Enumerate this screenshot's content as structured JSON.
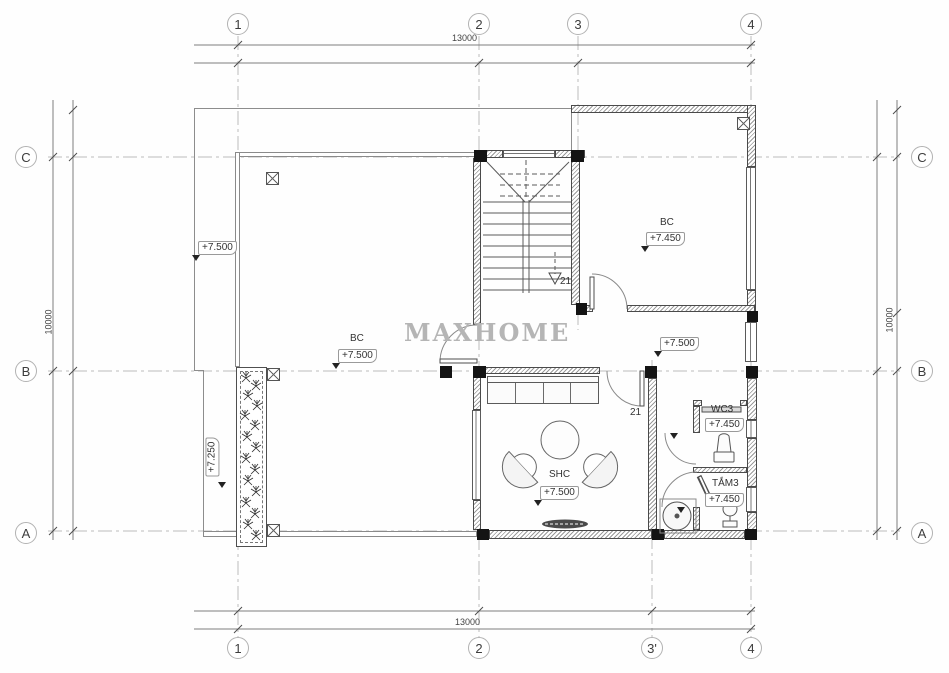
{
  "watermark": "MAXHOME",
  "grid": {
    "top": [
      "1",
      "2",
      "3",
      "4"
    ],
    "bottom": [
      "1",
      "2",
      "3'",
      "4"
    ],
    "left": [
      "C",
      "B",
      "A"
    ],
    "right": [
      "C",
      "B",
      "A"
    ]
  },
  "dims": {
    "top": "13000",
    "bottom": "13000",
    "left": "10000",
    "right": "10000"
  },
  "rooms": {
    "terrace": "BC",
    "balcony": "BC",
    "living": "SHC",
    "wc": "WC3",
    "bath": "TẮM3"
  },
  "levels": {
    "terrace_upper": "+7.500",
    "terrace": "+7.500",
    "balcony": "+7.450",
    "hall": "+7.500",
    "living": "+7.500",
    "wc": "+7.450",
    "bath": "+7.450",
    "planter": "+7.250"
  },
  "tags": {
    "stair_steps": "21",
    "door_living": "21"
  },
  "colors": {
    "line": "#555555",
    "grid": "#b9b9b9",
    "wall_hatch": "#9a9a9a",
    "column": "#141414",
    "watermark": "#b5b5b5"
  }
}
